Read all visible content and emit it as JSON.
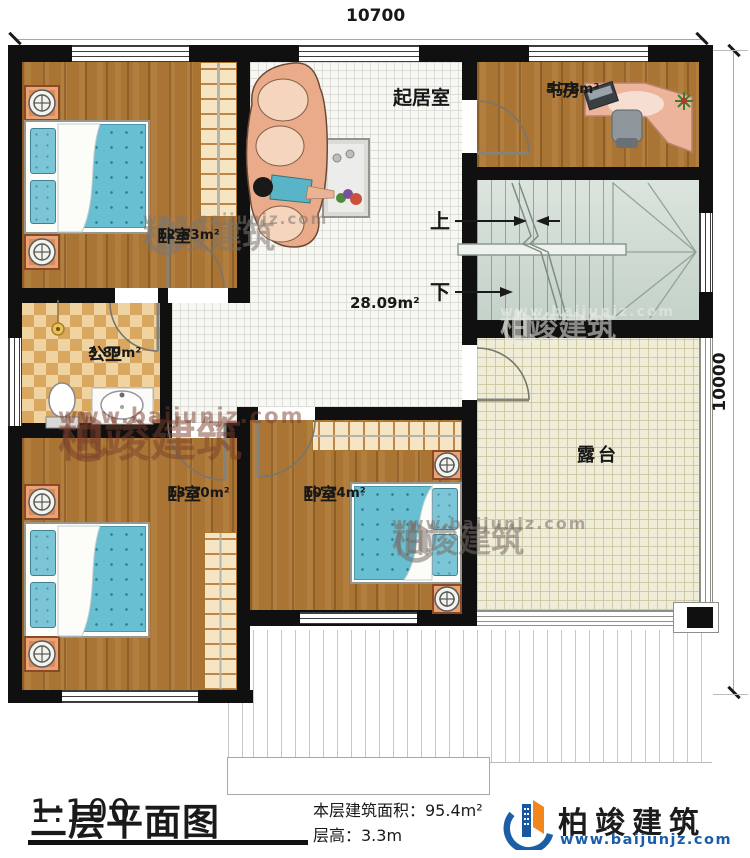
{
  "plan": {
    "dim_top": "10700",
    "dim_right": "10000",
    "rooms": {
      "bedroom1": {
        "label": "卧室",
        "area": "12.63m²"
      },
      "living": {
        "label": "起居室",
        "area": "28.09m²"
      },
      "study": {
        "label": "书房",
        "area": "5.78m²"
      },
      "bathroom": {
        "label": "公卫",
        "area": "3.89m²"
      },
      "bedroom2": {
        "label": "卧室",
        "area": "13.30m²"
      },
      "bedroom3": {
        "label": "卧室",
        "area": "10.34m²"
      },
      "terrace": {
        "label": "露台"
      }
    },
    "stairs": {
      "up": "上",
      "down": "下"
    }
  },
  "footer": {
    "title": "二层平面图",
    "scale": "1:100",
    "area_line": "本层建筑面积：95.4m²",
    "height_line": "层高：3.3m"
  },
  "brand": {
    "name": "柏竣建筑",
    "site": "www.baijunjz.com"
  },
  "watermark": {
    "name": "柏竣建筑",
    "site": "www.baijunjz.com"
  },
  "colors": {
    "wall": "#101010",
    "wood": "#a97434",
    "accent_blue": "#1b5ea6",
    "accent_orange": "#f0861c",
    "stairs": "#ccd8d0",
    "terrace": "#efecd8"
  }
}
